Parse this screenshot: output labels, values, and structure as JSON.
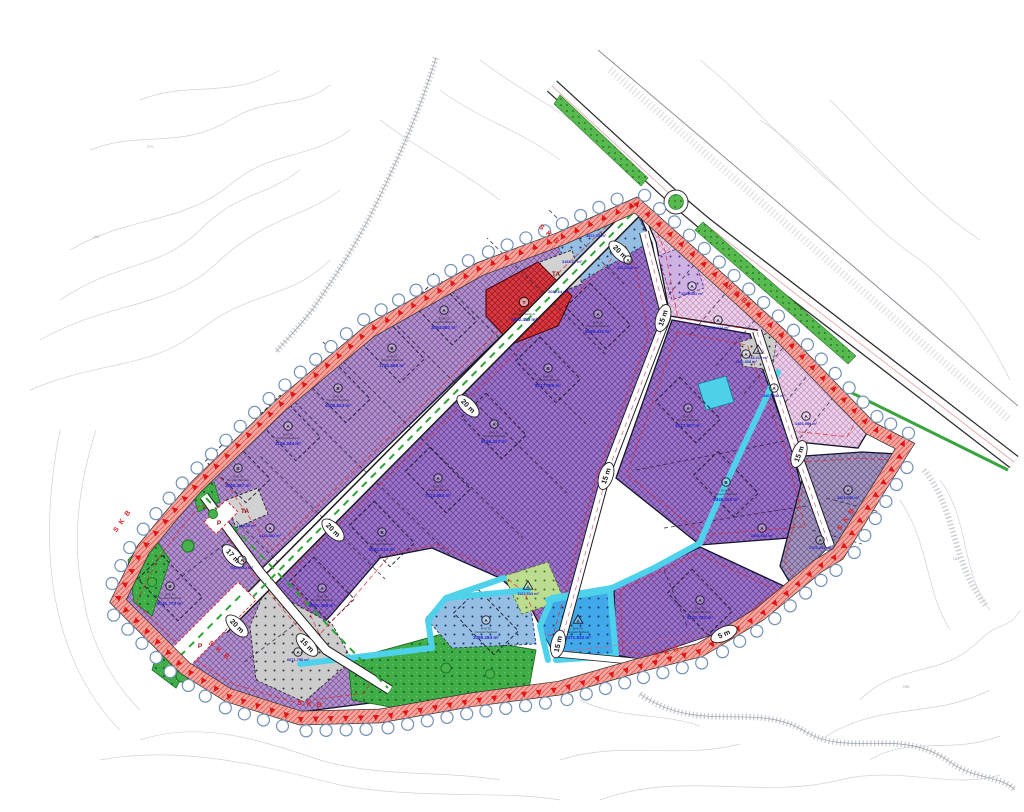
{
  "map": {
    "type": "zoning-development-plan",
    "road_labels": [
      {
        "t": "20 m",
        "x": 620,
        "y": 252,
        "r": 45
      },
      {
        "t": "20 m",
        "x": 468,
        "y": 406,
        "r": 45
      },
      {
        "t": "20 m",
        "x": 333,
        "y": 530,
        "r": 45
      },
      {
        "t": "20 m",
        "x": 237,
        "y": 626,
        "r": 45
      },
      {
        "t": "15 m",
        "x": 663,
        "y": 318,
        "r": -72
      },
      {
        "t": "15 m",
        "x": 606,
        "y": 476,
        "r": -72
      },
      {
        "t": "15 m",
        "x": 558,
        "y": 644,
        "r": -78
      },
      {
        "t": "15 m",
        "x": 799,
        "y": 454,
        "r": -70
      },
      {
        "t": "17 m",
        "x": 233,
        "y": 556,
        "r": 47
      },
      {
        "t": "15 m",
        "x": 307,
        "y": 645,
        "r": 47
      },
      {
        "t": "5 m",
        "x": 724,
        "y": 634,
        "r": -25
      }
    ],
    "skb_labels": [
      {
        "t": "S K B",
        "x": 548,
        "y": 236,
        "r": 43
      },
      {
        "t": "S K B",
        "x": 124,
        "y": 522,
        "r": -55
      },
      {
        "t": "S K B",
        "x": 218,
        "y": 652,
        "r": 40
      },
      {
        "t": "S.K.B",
        "x": 310,
        "y": 706,
        "r": 6
      },
      {
        "t": "S K B",
        "x": 668,
        "y": 654,
        "r": -18
      },
      {
        "t": "S K B",
        "x": 848,
        "y": 520,
        "r": -55
      },
      {
        "t": "S K B",
        "x": 736,
        "y": 296,
        "r": 42
      }
    ],
    "zone_labels": [
      {
        "t": "TA",
        "x": 556,
        "y": 276
      },
      {
        "t": "TA",
        "x": 245,
        "y": 513
      },
      {
        "t": "P",
        "x": 200,
        "y": 648
      },
      {
        "t": "P",
        "x": 219,
        "y": 525
      }
    ],
    "contour_labels": [
      {
        "t": "270",
        "x": 150,
        "y": 148
      },
      {
        "t": "266",
        "x": 96,
        "y": 238
      },
      {
        "t": "258",
        "x": 906,
        "y": 688
      },
      {
        "t": "252",
        "x": 956,
        "y": 560
      }
    ],
    "parcel_note_lines": [
      "E=0.70",
      "Yençok=Serbest"
    ],
    "annotations": [
      {
        "s": "B",
        "x": 238,
        "y": 468,
        "a": "2860.387 m²",
        "env": 1
      },
      {
        "s": "A",
        "x": 288,
        "y": 426,
        "a": "3155.244 m²",
        "env": 1
      },
      {
        "s": "B",
        "x": 338,
        "y": 388,
        "a": "4408.624 m²",
        "env": 1
      },
      {
        "s": "B",
        "x": 392,
        "y": 348,
        "a": "1781.666 m²",
        "env": 1
      },
      {
        "s": "A",
        "x": 444,
        "y": 310,
        "a": "3094.082 m²",
        "env": 1
      },
      {
        "s": "A",
        "x": 322,
        "y": 588,
        "a": "8901.368 m²",
        "env": 1
      },
      {
        "s": "B",
        "x": 382,
        "y": 532,
        "a": "8651.913 m²",
        "env": 1
      },
      {
        "s": "A",
        "x": 438,
        "y": 478,
        "a": "7423.884 m²",
        "env": 1
      },
      {
        "s": "A",
        "x": 494,
        "y": 424,
        "a": "9156.227 m²",
        "env": 1
      },
      {
        "s": "B",
        "x": 548,
        "y": 368,
        "a": "8017.909 m²",
        "env": 1
      },
      {
        "s": "A",
        "x": 598,
        "y": 314,
        "a": "5689.431 m²",
        "env": 1
      },
      {
        "s": "A",
        "x": 628,
        "y": 260,
        "a": "3310.246 m²",
        "sm": 1
      },
      {
        "s": "A",
        "x": 688,
        "y": 408,
        "a": "4417.507 m²",
        "env": 1
      },
      {
        "s": "B",
        "x": 726,
        "y": 482,
        "a": "6340.118 m²",
        "env": 1
      },
      {
        "s": "A",
        "x": 762,
        "y": 528,
        "a": "2851.664 m²",
        "sm": 1
      },
      {
        "s": "A",
        "x": 700,
        "y": 600,
        "a": "8101.763 m²",
        "env": 1
      },
      {
        "s": "A",
        "x": 848,
        "y": 490,
        "a": "3921.556 m²",
        "sm": 1
      },
      {
        "s": "A",
        "x": 820,
        "y": 540,
        "a": "2703.341 m²",
        "sm": 1
      },
      {
        "s": "A",
        "x": 692,
        "y": 286,
        "a": "1034.551 m²",
        "sm": 1
      },
      {
        "s": "A",
        "x": 718,
        "y": 320,
        "a": "1218.374 m²",
        "sm": 1
      },
      {
        "s": "A",
        "x": 746,
        "y": 354,
        "a": "1122.808 m²",
        "sm": 1
      },
      {
        "s": "A",
        "x": 774,
        "y": 388,
        "a": "1307.442 m²",
        "sm": 1
      },
      {
        "s": "A",
        "x": 806,
        "y": 416,
        "a": "1466.059 m²",
        "sm": 1
      },
      {
        "s": "B",
        "x": 170,
        "y": 586,
        "a": "5241.773 m²",
        "env": 1
      },
      {
        "s": "A",
        "x": 242,
        "y": 560,
        "a": "2944.162 m²",
        "sm": 1
      },
      {
        "s": "A",
        "x": 270,
        "y": 528,
        "a": "3118.452 m²",
        "sm": 1
      },
      {
        "s": "A",
        "x": 298,
        "y": 652,
        "a": "6071.795 m²",
        "sm": 1
      },
      {
        "s": "A",
        "x": 486,
        "y": 620,
        "a": "3386.284 m²",
        "env": 1
      },
      {
        "s": "tri",
        "x": 578,
        "y": 620,
        "a": "2471.932 m²"
      },
      {
        "s": "tri",
        "x": 528,
        "y": 586,
        "a": "1122.603 m²",
        "sm": 1
      },
      {
        "s": "tri",
        "x": 758,
        "y": 350,
        "a": "743.219 m²",
        "sm": 1
      },
      {
        "s": "",
        "x": 596,
        "y": 234,
        "a": "3872.55 m²",
        "sm": 1
      },
      {
        "s": "",
        "x": 572,
        "y": 260,
        "a": "3164.27 m²",
        "sm": 1
      },
      {
        "s": "",
        "x": 558,
        "y": 290,
        "a": "2034.64 m²",
        "sm": 1
      },
      {
        "s": "T",
        "x": 524,
        "y": 302,
        "a": "2962.453 m²"
      },
      {
        "s": "",
        "x": 246,
        "y": 524,
        "a": "1109.32 m²",
        "sm": 1
      }
    ],
    "colors": {
      "industrial_purple": "#9d74cb",
      "industrial_light": "#b391cf",
      "commercial_red": "#dd3a43",
      "mixed_pink": "#ead2e8",
      "social_blue": "#96bde2",
      "worship_blue": "#41a9e9",
      "park_green": "#3fae49",
      "technical_gray": "#cccccc",
      "channel_cyan": "#4ed2ec",
      "band_red": "#e02020",
      "area_text_blue": "#2424cc",
      "median_green": "#2ea335"
    }
  }
}
